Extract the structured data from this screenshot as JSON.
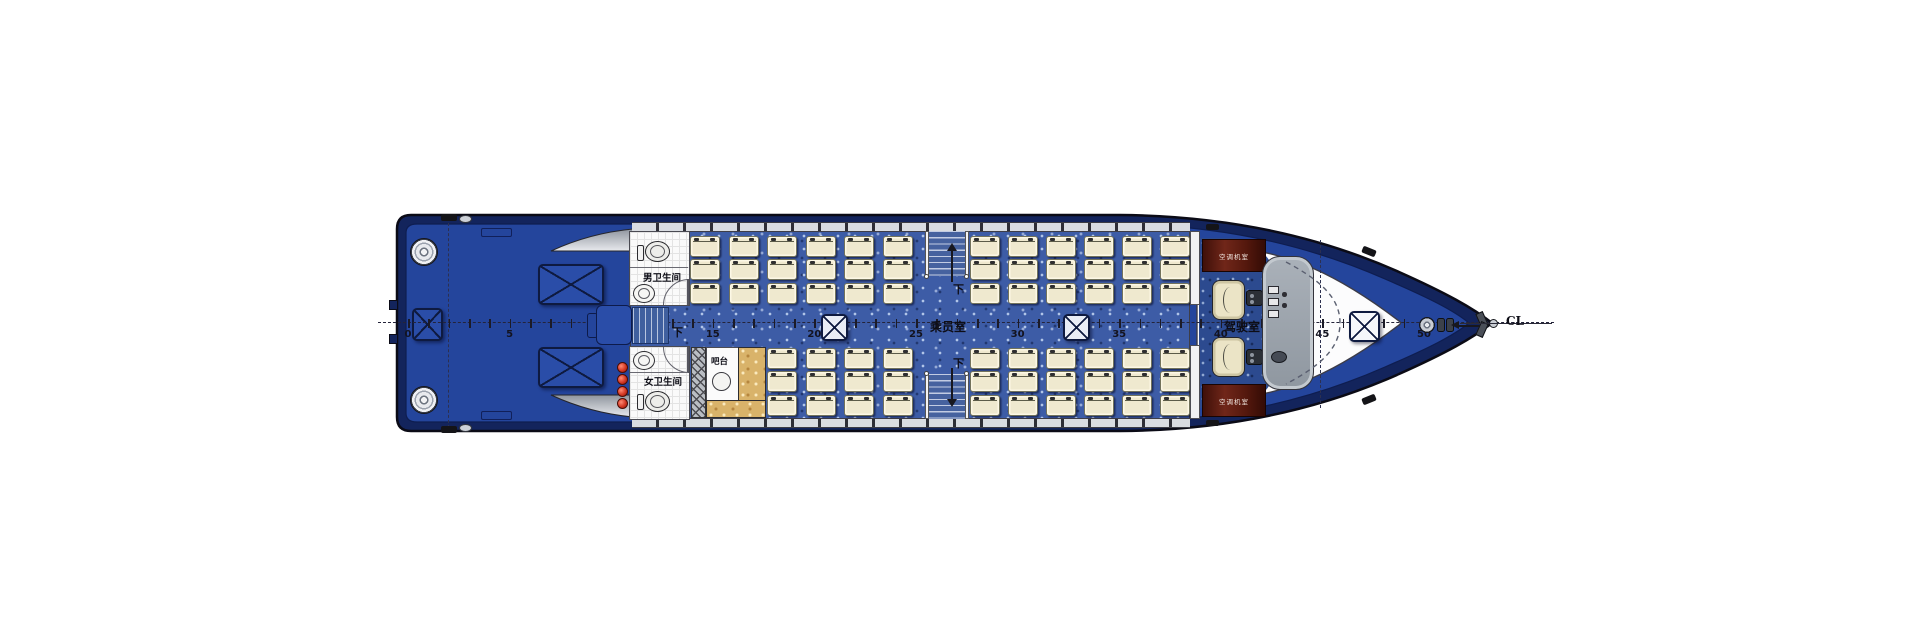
{
  "drawing_type": "ship main deck general arrangement plan (top view, bow to the right)",
  "labels": {
    "men_toilet": "男卫生间",
    "women_toilet": "女卫生间",
    "bar": "吧台",
    "passenger_cabin": "乘员室",
    "wheelhouse": "驾驶室",
    "ac_cabinet_port": "空调机室",
    "ac_cabinet_starboard": "空调机室",
    "stair_down_aft": "下",
    "stair_down_port": "下",
    "stair_down_starboard": "下",
    "centerline": "CL"
  },
  "frame_scale": {
    "tick_labels": [
      "0",
      "5",
      "10",
      "15",
      "20",
      "25",
      "30",
      "35",
      "40",
      "45",
      "50"
    ],
    "minor_tick_interval": 1,
    "labeled_interval": 5,
    "frames_total": 51
  },
  "seating": {
    "rows_per_column": 3,
    "port_aft_columns": 6,
    "starboard_aft_columns": 4,
    "port_forward_columns": 6,
    "starboard_forward_columns": 6,
    "passenger_seats_total": 66,
    "crew_chairs": 2
  },
  "equipment": {
    "stern_deck_hatches": 2,
    "transom_hatch": 1,
    "aisle_hatches": 2,
    "foredeck_hatch": 1,
    "mooring_bollards": 2,
    "fire_extinguishers": 4,
    "toilets": 2,
    "wash_basins": 2,
    "bar_stool": 1,
    "stairways_down": 3,
    "side_ladder": 1,
    "bow_capstan": 1,
    "bow_bitts": 2
  },
  "colors": {
    "hull_band": "#13245c",
    "deck_blue": "#24459c",
    "cabin_carpet": "#3d5ca6",
    "wheelhouse_carpet": "#2c4a8f",
    "seat_cream": "#efe9cf",
    "bar_counter_tan": "#d9b36a",
    "cabinet_red": "#5f1f12",
    "console_gray": "#9aa2ab",
    "extinguisher_red": "#d23723"
  }
}
